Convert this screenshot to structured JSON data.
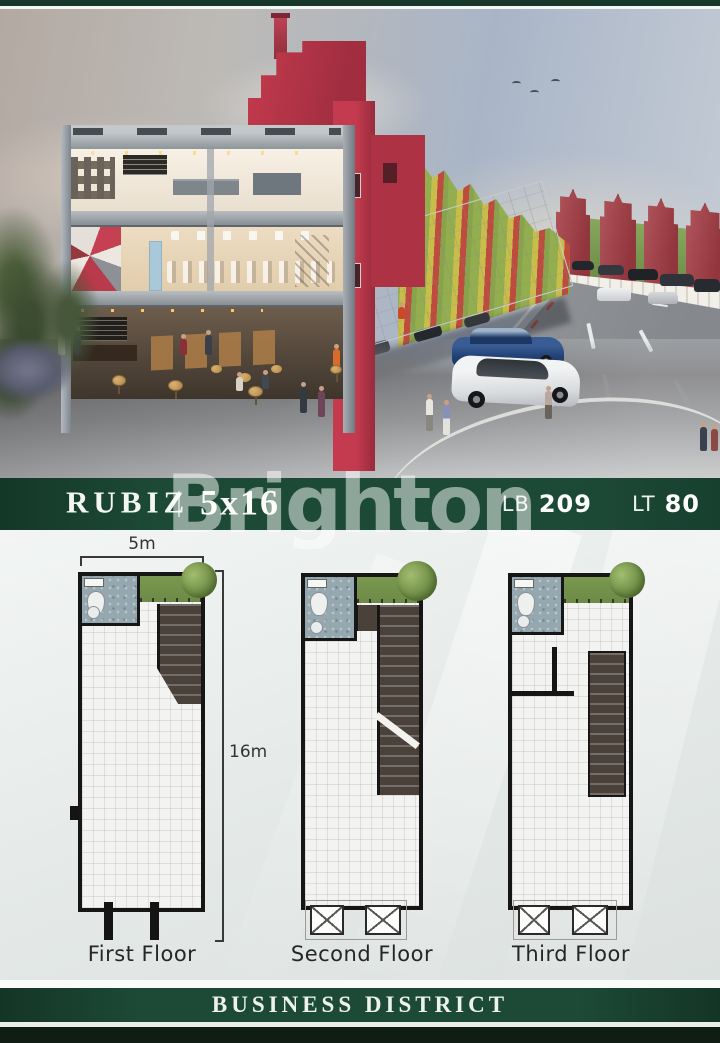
{
  "listing": {
    "name": "RUBIZ",
    "size": "5x16",
    "building_area_label": "LB",
    "building_area_value": "209",
    "land_area_label": "LT",
    "land_area_value": "80"
  },
  "watermark": "Brighton",
  "floor_plans": {
    "width_dimension": "5m",
    "height_dimension": "16m",
    "floors": [
      {
        "label": "First Floor"
      },
      {
        "label": "Second Floor"
      },
      {
        "label": "Third Floor"
      }
    ]
  },
  "footer": {
    "title": "BUSINESS DISTRICT"
  },
  "colors": {
    "brand_green": "#1d4a37",
    "brand_green_dark": "#16372a",
    "footer_dark": "#0f1d15",
    "building_red": "#c43a4e",
    "plan_wall": "#161616",
    "garden_green": "#7b9850",
    "stair_brown": "#4a413a",
    "bathroom_tile": "#95a7af"
  }
}
